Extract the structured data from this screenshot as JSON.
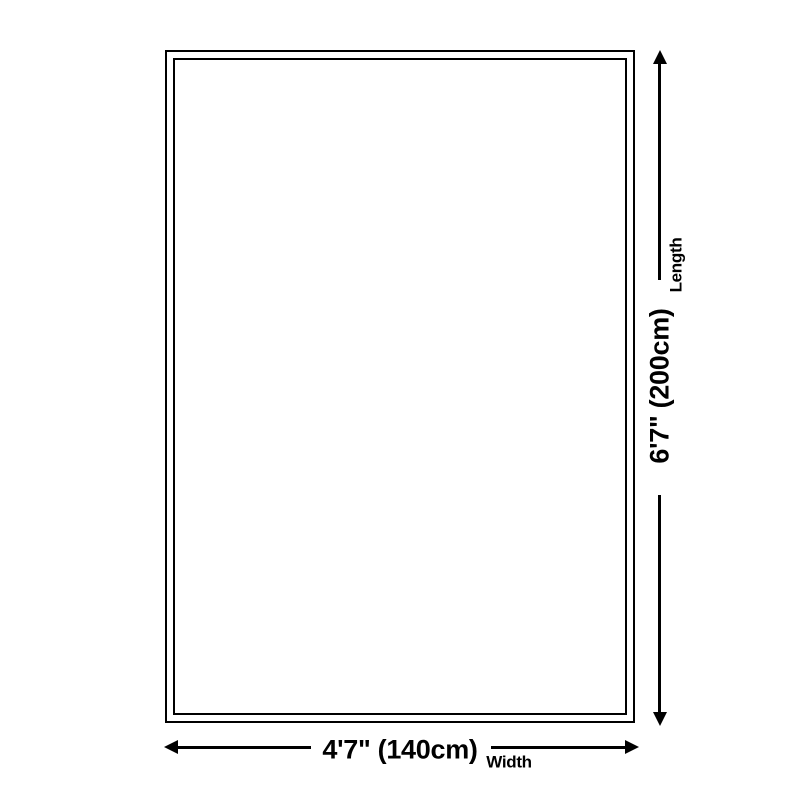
{
  "colors": {
    "background": "#ffffff",
    "line": "#000000",
    "text": "#000000"
  },
  "product": {
    "shape": "rectangle-double-border"
  },
  "icons": {
    "length_arrow": "double-headed-vertical-arrow",
    "width_arrow": "double-headed-horizontal-arrow"
  },
  "dimensions": {
    "length": {
      "value": "6'7\" (200cm)",
      "label": "Length"
    },
    "width": {
      "value": "4'7\" (140cm)",
      "label": "Width"
    }
  }
}
